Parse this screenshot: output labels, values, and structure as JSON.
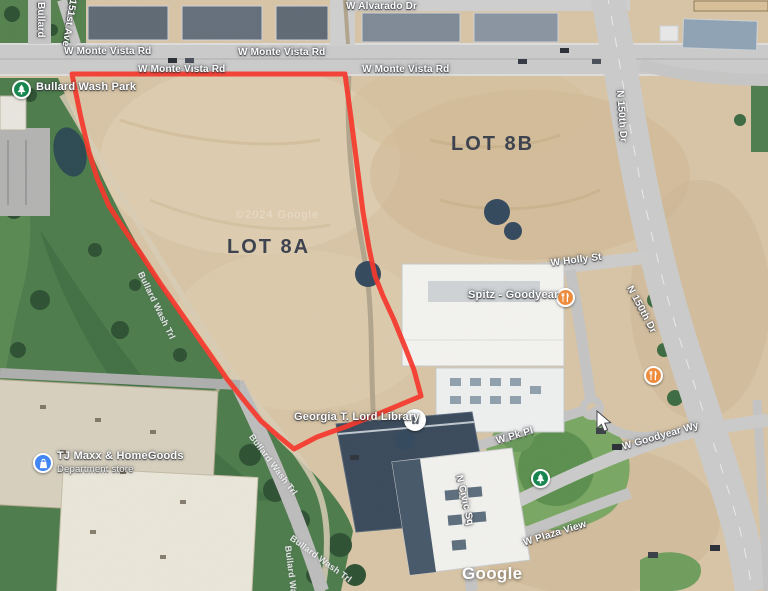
{
  "map": {
    "annotations": {
      "lot_a": "LOT 8A",
      "lot_b": "LOT 8B"
    },
    "roads": [
      {
        "label": "W Alvarado Dr"
      },
      {
        "label": "W Monte Vista Rd"
      },
      {
        "label": "W Monte Vista Rd"
      },
      {
        "label": "W Monte Vista Rd"
      },
      {
        "label": "W Monte Vista Rd"
      },
      {
        "label": "Bullard"
      },
      {
        "label": "151st Ave"
      },
      {
        "label": "N 150th Dr"
      },
      {
        "label": "W Holly St"
      },
      {
        "label": "N 150th Dr"
      },
      {
        "label": "W Pk Pl"
      },
      {
        "label": "W Goodyear Wy"
      },
      {
        "label": "N Civic Sq"
      },
      {
        "label": "W Plaza View"
      }
    ],
    "trails": [
      "Bullard Wash Trl",
      "Bullard Wash Trl",
      "Bullard Wash Trl",
      "Bullard Wash Trl"
    ],
    "pois": {
      "park": {
        "name": "Bullard Wash Park",
        "icon": "tree-icon"
      },
      "restaurant": {
        "name": "Spitz - Goodyear",
        "icon": "restaurant-icon"
      },
      "library": {
        "name": "Georgia T. Lord Library",
        "icon": "library-icon"
      },
      "store": {
        "name": "TJ Maxx & HomeGoods",
        "subtitle": "Department store",
        "icon": "shopping-icon"
      },
      "restaurant2": {
        "icon": "restaurant-icon"
      },
      "park2": {
        "icon": "tree-icon"
      }
    },
    "tile_watermark": "©2024 Google",
    "logo": "Google",
    "colors": {
      "boundary_red": "#f4392d",
      "park_pin_green": "#17854d",
      "restaurant_pin_orange": "#ee8c3e",
      "store_pin_blue": "#4285f4",
      "lot_label_ink": "#3e4350"
    }
  }
}
